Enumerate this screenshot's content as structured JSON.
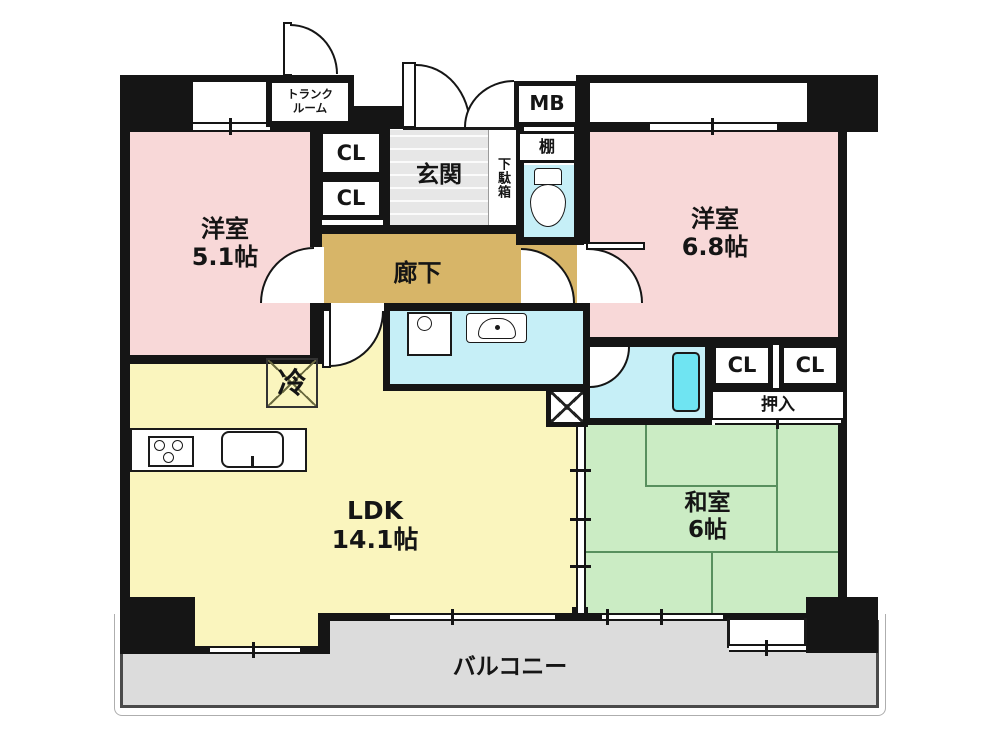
{
  "rooms": {
    "western_room_1": {
      "name": "洋室",
      "size": "5.1帖"
    },
    "western_room_2": {
      "name": "洋室",
      "size": "6.8帖"
    },
    "ldk": {
      "name": "LDK",
      "size": "14.1帖"
    },
    "japanese_room": {
      "name": "和室",
      "size": "6帖"
    },
    "corridor": {
      "name": "廊下"
    },
    "entrance": {
      "name": "玄関"
    },
    "balcony": {
      "name": "バルコニー"
    }
  },
  "features": {
    "trunk_room_line1": "トランク",
    "trunk_room_line2": "ルーム",
    "closet": "CL",
    "meter_box": "MB",
    "shelf": "棚",
    "shoe_cabinet": "下駄箱",
    "oshiire": "押入",
    "refrigerator": "冷"
  },
  "colors": {
    "western_room": "#F8D8D8",
    "ldk": "#FAF5BE",
    "japanese_room": "#CBECC4",
    "corridor": "#D7B568",
    "wet_area": "#C6EFF7",
    "bathtub": "#6FE4F2",
    "balcony": "#DCDCDC",
    "wall": "#151515"
  }
}
